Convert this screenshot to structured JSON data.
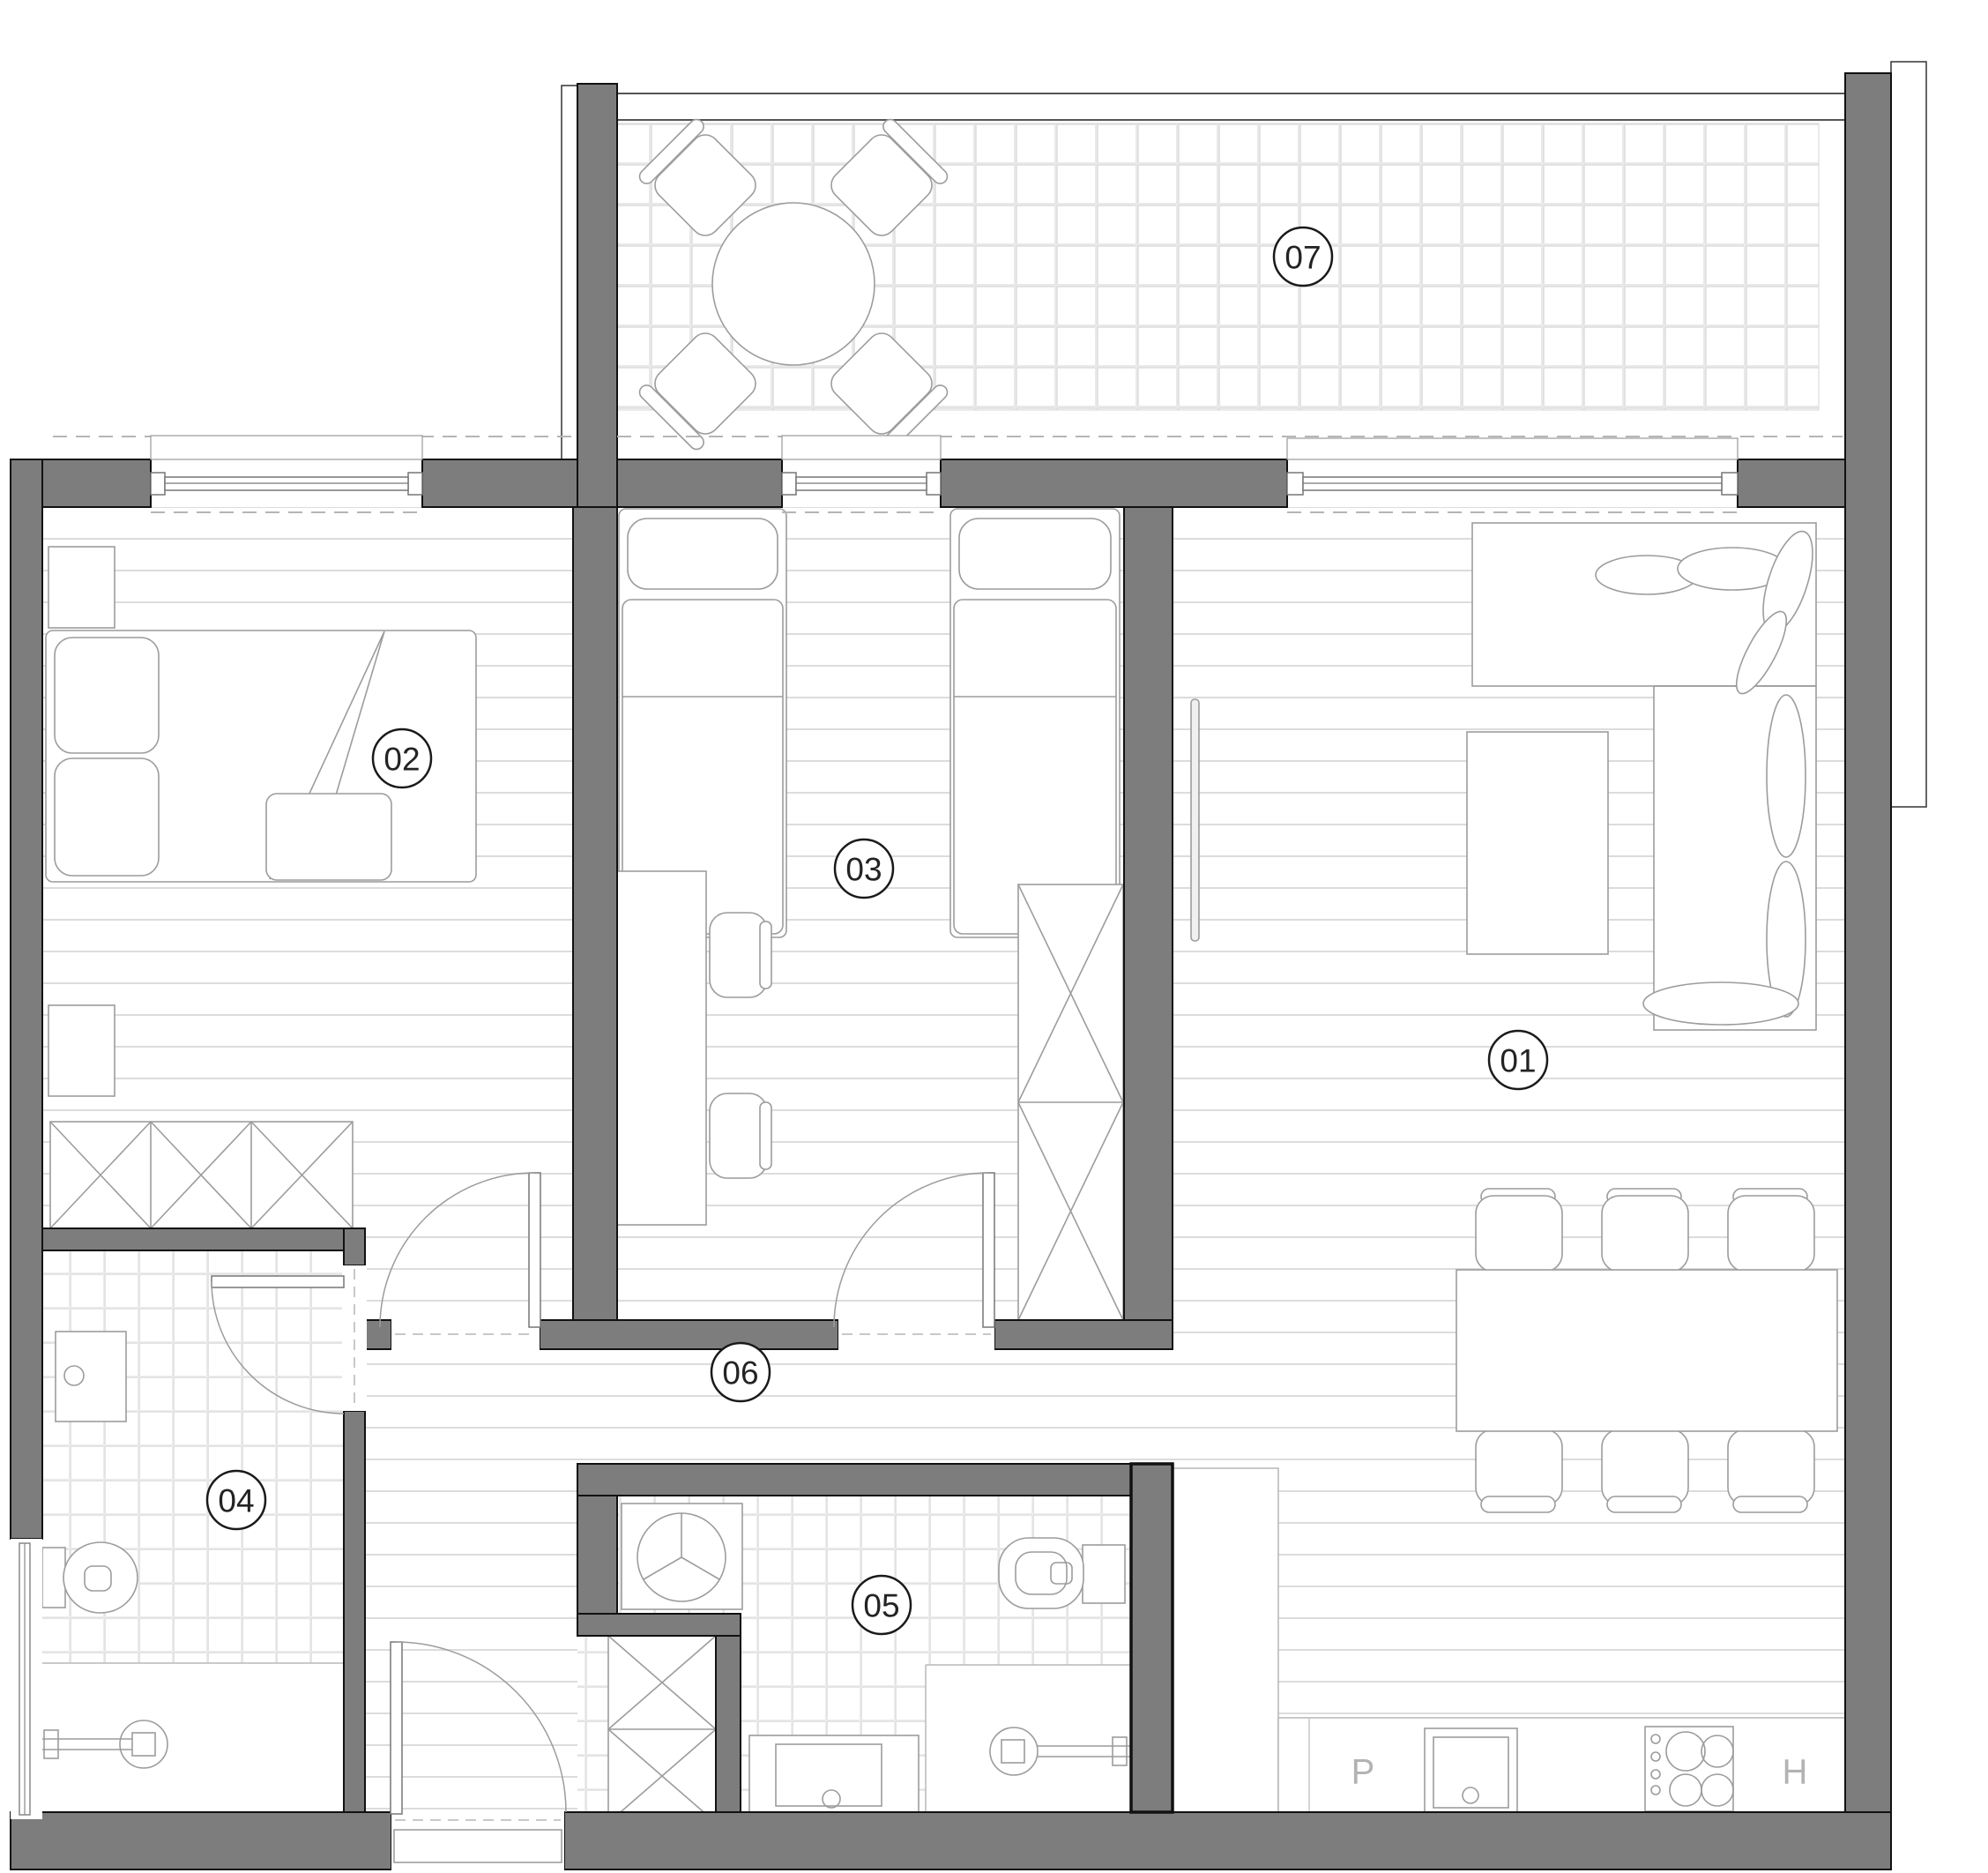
{
  "floorplan": {
    "title": "apartment-floor-plan",
    "room_labels": [
      {
        "label": "01"
      },
      {
        "label": "02"
      },
      {
        "label": "03"
      },
      {
        "label": "04"
      },
      {
        "label": "05"
      },
      {
        "label": "06"
      },
      {
        "label": "07"
      }
    ],
    "kitchen": {
      "labels": [
        {
          "text": "P"
        },
        {
          "text": "H"
        }
      ]
    },
    "colors": {
      "wall_fill": "#7d7d7d",
      "wall_outline": "#111111",
      "furniture_line": "#9c9c9c",
      "floor_plank_line": "#dcdcdc",
      "tile_line": "#e4e4e4",
      "dashed_line": "#b5b5b5",
      "label_ring": "#1a1a1a",
      "label_text": "#232323",
      "kitchen_letter": "#b3b3b3",
      "background": "#ffffff"
    }
  }
}
